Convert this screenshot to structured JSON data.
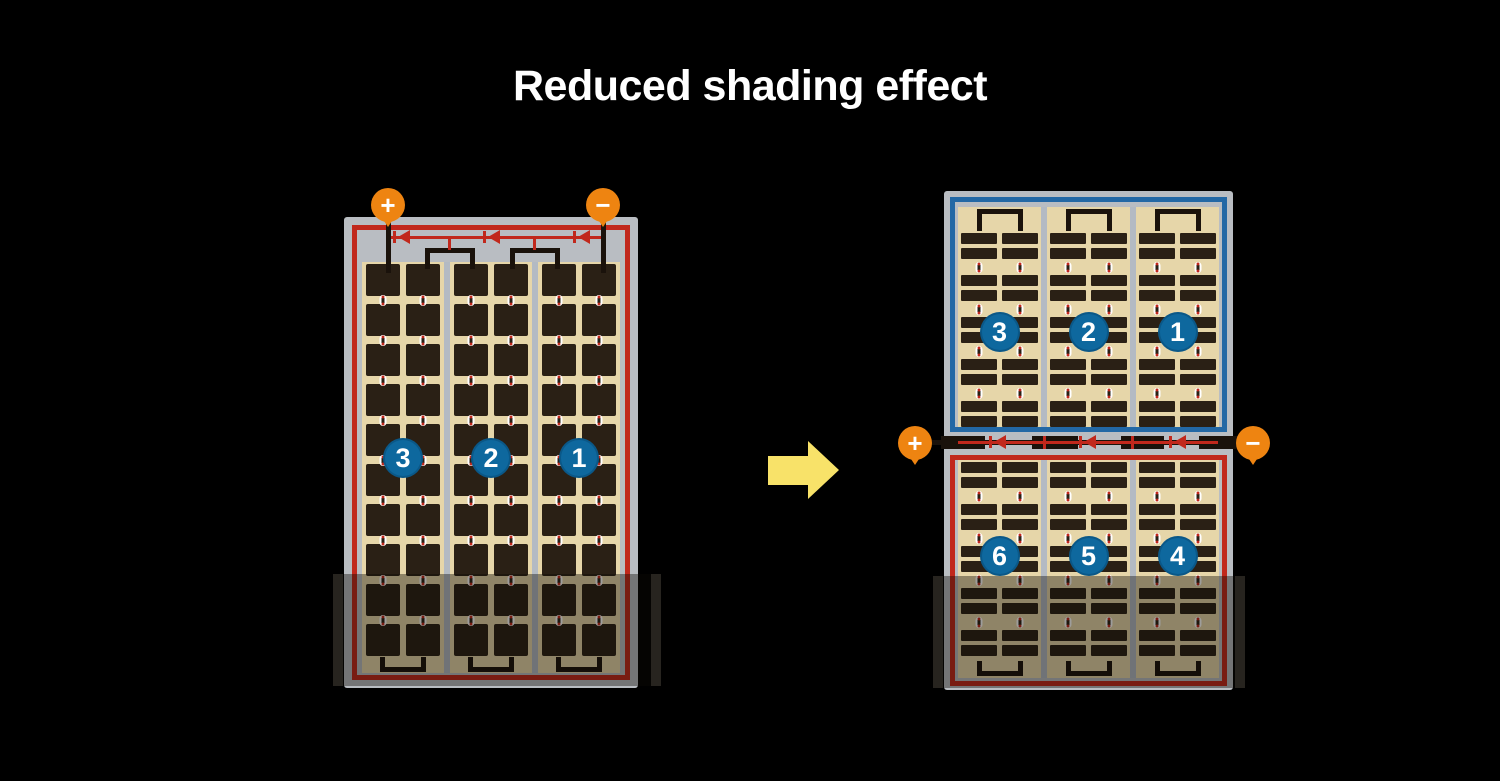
{
  "title": "Reduced shading effect",
  "colors": {
    "background": "#000000",
    "title_text": "#ffffff",
    "frame_gray": "#b9bdc2",
    "divider_gray": "#b3bac3",
    "string_red": "#c1281c",
    "string_blue": "#2368a5",
    "circle_blue": "#0e689e",
    "terminal_orange": "#ee8411",
    "cell_dark": "#2a2015",
    "tan": "#e6d6a9",
    "arrow_yellow": "#f8e269",
    "diode_red": "#c1281c",
    "wire_black": "#1a120b"
  },
  "left_panel": {
    "terminals": {
      "plus": "+",
      "minus": "−"
    },
    "strings": [
      {
        "number": "3"
      },
      {
        "number": "2"
      },
      {
        "number": "1"
      }
    ]
  },
  "right_panel": {
    "terminals": {
      "plus": "+",
      "minus": "−"
    },
    "top_string": {
      "sections": [
        {
          "number": "3"
        },
        {
          "number": "2"
        },
        {
          "number": "1"
        }
      ]
    },
    "bottom_string": {
      "sections": [
        {
          "number": "6"
        },
        {
          "number": "5"
        },
        {
          "number": "4"
        }
      ]
    }
  }
}
